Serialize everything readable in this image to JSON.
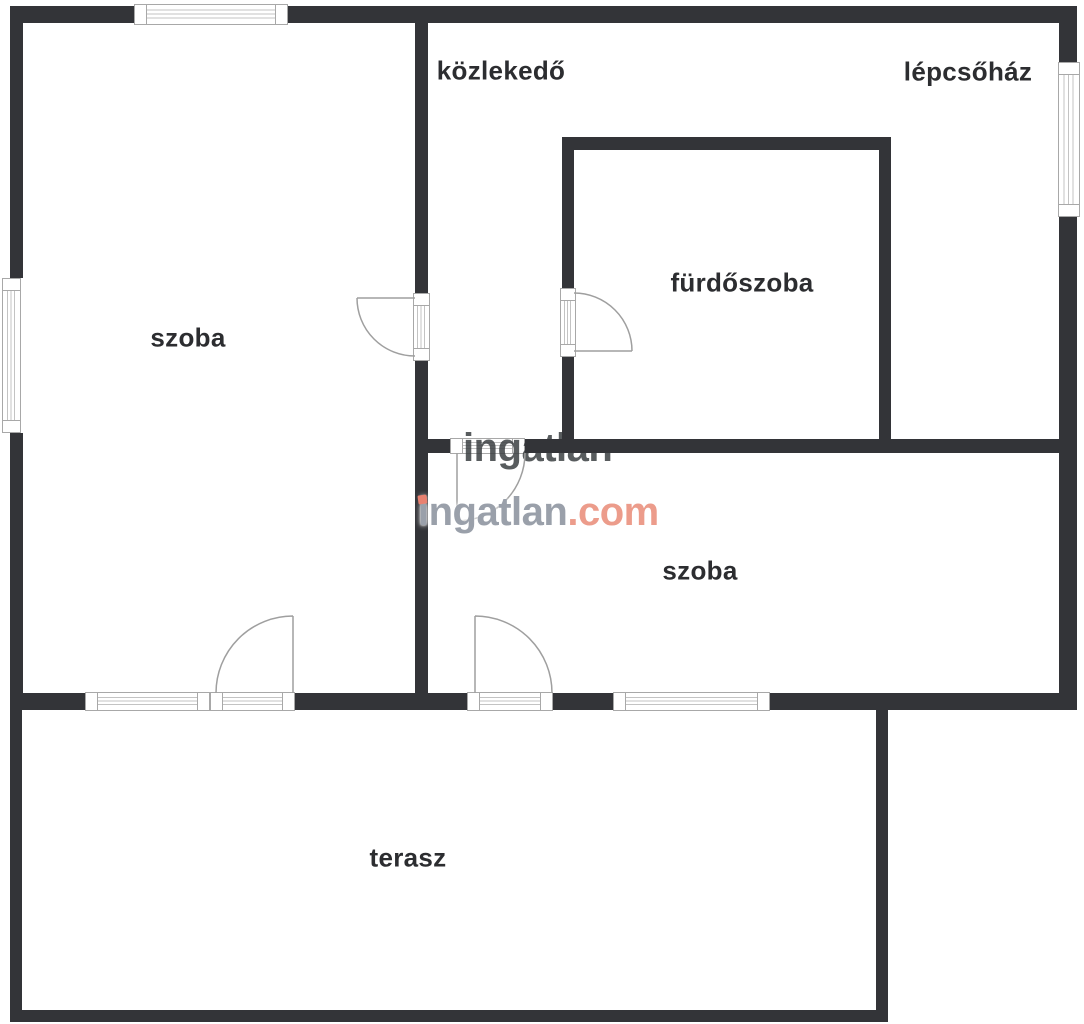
{
  "page": {
    "background": "#ffffff"
  },
  "watermark": {
    "text_gray": "ingatlan",
    "text_accent": ".com",
    "gray_color": "#9aa0aa",
    "accent_color": "#ec9c8b",
    "dot_color": "#e98170",
    "fragment_text": "ingatlan",
    "fragment_color": "#3c4043"
  },
  "rooms": [
    {
      "id": "szoba-left",
      "label": "szoba",
      "x": 188,
      "y": 338
    },
    {
      "id": "kozlekedo",
      "label": "közlekedő",
      "x": 501,
      "y": 71
    },
    {
      "id": "lepcsohaz",
      "label": "lépcsőház",
      "x": 968,
      "y": 72
    },
    {
      "id": "furdoszoba",
      "label": "fürdőszoba",
      "x": 742,
      "y": 283
    },
    {
      "id": "szoba-right",
      "label": "szoba",
      "x": 700,
      "y": 571
    },
    {
      "id": "terasz",
      "label": "terasz",
      "x": 408,
      "y": 858
    }
  ],
  "floorplan": {
    "wall_color": "#333438",
    "door_stroke": "#9f9f9f",
    "window_border": "#a8a8a8",
    "walls": [
      {
        "x": 10,
        "y": 6,
        "w": 124,
        "h": 17
      },
      {
        "x": 288,
        "y": 6,
        "w": 789,
        "h": 17
      },
      {
        "x": 10,
        "y": 6,
        "w": 13,
        "h": 272
      },
      {
        "x": 10,
        "y": 433,
        "w": 13,
        "h": 277
      },
      {
        "x": 1059,
        "y": 6,
        "w": 18,
        "h": 56
      },
      {
        "x": 1059,
        "y": 217,
        "w": 18,
        "h": 493
      },
      {
        "x": 10,
        "y": 693,
        "w": 75,
        "h": 17
      },
      {
        "x": 295,
        "y": 693,
        "w": 172,
        "h": 17
      },
      {
        "x": 553,
        "y": 693,
        "w": 60,
        "h": 17
      },
      {
        "x": 770,
        "y": 693,
        "w": 307,
        "h": 17
      },
      {
        "x": 415,
        "y": 23,
        "w": 13,
        "h": 270
      },
      {
        "x": 415,
        "y": 361,
        "w": 13,
        "h": 332
      },
      {
        "x": 428,
        "y": 439,
        "w": 22,
        "h": 14
      },
      {
        "x": 525,
        "y": 439,
        "w": 534,
        "h": 14
      },
      {
        "x": 562,
        "y": 137,
        "w": 329,
        "h": 13
      },
      {
        "x": 562,
        "y": 150,
        "w": 12,
        "h": 138
      },
      {
        "x": 562,
        "y": 357,
        "w": 12,
        "h": 82
      },
      {
        "x": 879,
        "y": 150,
        "w": 12,
        "h": 289
      },
      {
        "x": 10,
        "y": 710,
        "w": 12,
        "h": 312
      },
      {
        "x": 10,
        "y": 1010,
        "w": 878,
        "h": 12
      },
      {
        "x": 876,
        "y": 710,
        "w": 12,
        "h": 312
      }
    ],
    "windows": [
      {
        "kind": "window",
        "x": 134,
        "y": 4,
        "w": 154,
        "h": 21,
        "o": "h"
      },
      {
        "kind": "window",
        "x": 2,
        "y": 278,
        "w": 19,
        "h": 155,
        "o": "v"
      },
      {
        "kind": "window",
        "x": 1058,
        "y": 62,
        "w": 22,
        "h": 155,
        "o": "v"
      },
      {
        "kind": "window",
        "x": 85,
        "y": 692,
        "w": 125,
        "h": 19,
        "o": "h"
      },
      {
        "kind": "door-threshold",
        "x": 210,
        "y": 692,
        "w": 85,
        "h": 19,
        "o": "h"
      },
      {
        "kind": "door-threshold",
        "x": 467,
        "y": 692,
        "w": 86,
        "h": 19,
        "o": "h"
      },
      {
        "kind": "window",
        "x": 613,
        "y": 692,
        "w": 157,
        "h": 19,
        "o": "h"
      },
      {
        "kind": "door-threshold",
        "x": 413,
        "y": 293,
        "w": 17,
        "h": 68,
        "o": "v"
      },
      {
        "kind": "door-threshold",
        "x": 560,
        "y": 288,
        "w": 16,
        "h": 69,
        "o": "v"
      },
      {
        "kind": "door-threshold",
        "x": 450,
        "y": 438,
        "w": 75,
        "h": 16,
        "o": "h"
      }
    ],
    "doors": [
      {
        "path": "M357,298 L415,298 M357,298 A58,58 0 0 0 415,356"
      },
      {
        "path": "M574,351 L632,351 M574,293 A58,58 0 0 1 632,351"
      },
      {
        "path": "M457,453 L457,521 M457,521 A68,68 0 0 0 525,453"
      },
      {
        "path": "M293,693 L293,616 M293,616 A77,77 0 0 0 216,693"
      },
      {
        "path": "M475,693 L475,616 M475,616 A77,77 0 0 1 552,693"
      }
    ]
  }
}
